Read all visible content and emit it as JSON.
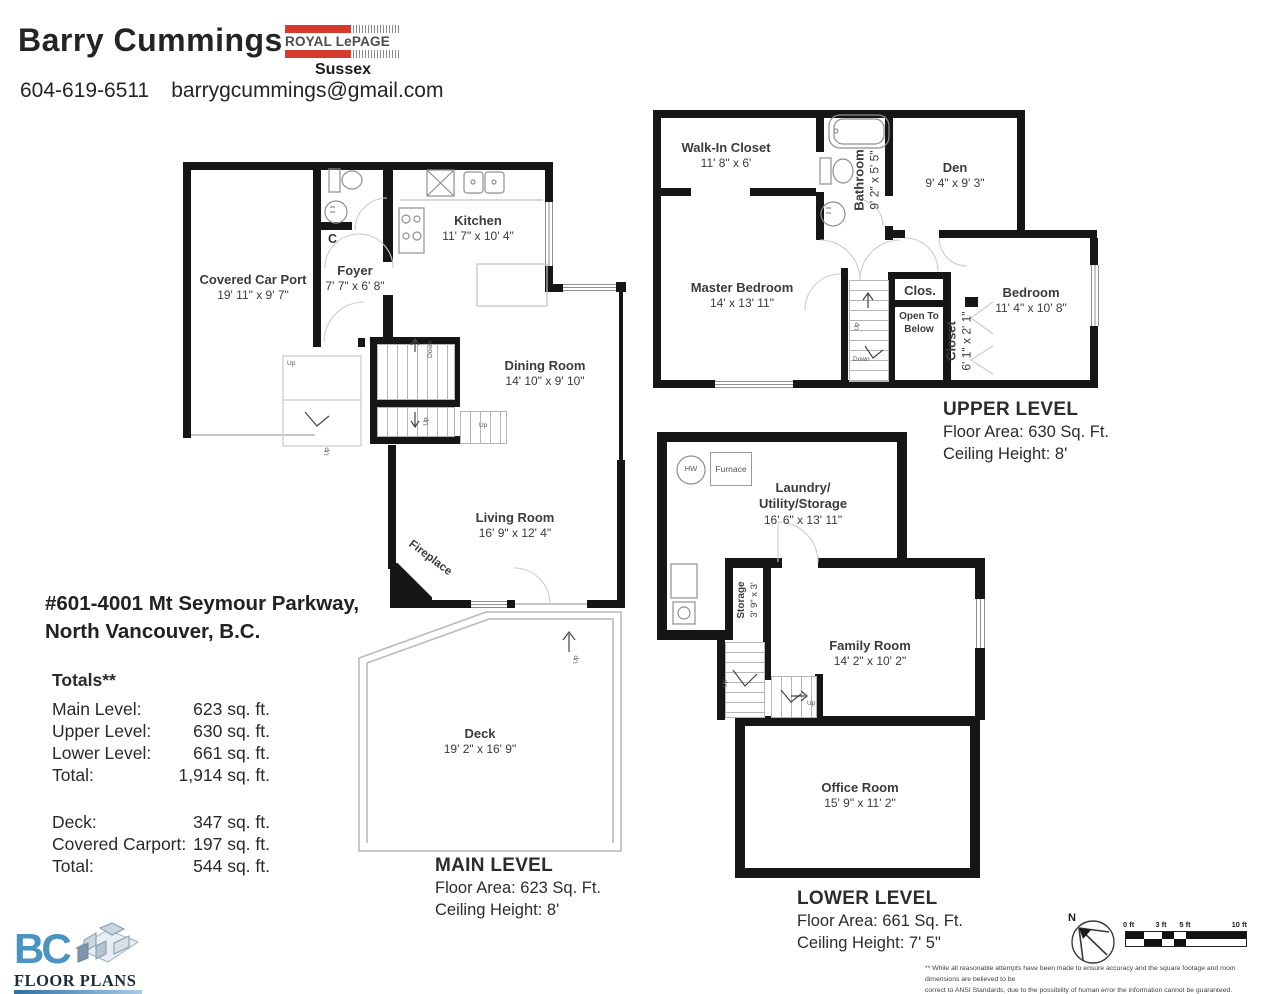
{
  "header": {
    "agent_name": "Barry Cummings",
    "phone": "604-619-6511",
    "email": "barrygcummings@gmail.com",
    "brokerage": {
      "brand": "ROYAL LePAGE",
      "office": "Sussex",
      "brand_color": "#d6392e"
    }
  },
  "address": {
    "line1": "#601-4001 Mt Seymour Parkway,",
    "line2": "North Vancouver, B.C."
  },
  "totals": {
    "title": "Totals**",
    "rows": [
      {
        "label": "Main Level:",
        "value": "623 sq. ft."
      },
      {
        "label": "Upper Level:",
        "value": "630 sq. ft."
      },
      {
        "label": "Lower Level:",
        "value": "661 sq. ft."
      },
      {
        "label": "Total:",
        "value": "1,914 sq. ft."
      }
    ],
    "rows2": [
      {
        "label": "Deck:",
        "value": "347 sq. ft."
      },
      {
        "label": "Covered Carport:",
        "value": "197 sq. ft."
      },
      {
        "label": "Total:",
        "value": "544 sq. ft."
      }
    ]
  },
  "levels": {
    "main": {
      "title": "MAIN LEVEL",
      "area": "Floor Area: 623 Sq. Ft.",
      "ceiling": "Ceiling Height: 8'"
    },
    "upper": {
      "title": "UPPER LEVEL",
      "area": "Floor Area: 630 Sq. Ft.",
      "ceiling": "Ceiling Height: 8'"
    },
    "lower": {
      "title": "LOWER LEVEL",
      "area": "Floor Area: 661 Sq. Ft.",
      "ceiling": "Ceiling Height: 7' 5\""
    }
  },
  "rooms": {
    "main": {
      "carport": {
        "name": "Covered Car Port",
        "dims": "19' 11\" x 9' 7\""
      },
      "foyer": {
        "name": "Foyer",
        "dims": "7' 7\" x 6' 8\""
      },
      "kitchen": {
        "name": "Kitchen",
        "dims": "11' 7\" x 10' 4\""
      },
      "dining": {
        "name": "Dining Room",
        "dims": "14' 10\" x 9' 10\""
      },
      "living": {
        "name": "Living Room",
        "dims": "16' 9\" x 12' 4\""
      },
      "deck": {
        "name": "Deck",
        "dims": "19' 2\" x 16' 9\""
      },
      "closet": {
        "name": "C"
      },
      "fireplace": {
        "name": "Fireplace"
      }
    },
    "upper": {
      "walkin": {
        "name": "Walk-In Closet",
        "dims": "11' 8\" x 6'"
      },
      "bathroom": {
        "name": "Bathroom",
        "dims": "9' 2\" x 5' 5\""
      },
      "den": {
        "name": "Den",
        "dims": "9' 4\" x 9' 3\""
      },
      "master": {
        "name": "Master Bedroom",
        "dims": "14' x 13' 11\""
      },
      "clos": {
        "name": "Clos."
      },
      "open_below": {
        "line1": "Open To",
        "line2": "Below"
      },
      "closet": {
        "name": "Closet",
        "dims": "6' 1\" x 2' 1\""
      },
      "bedroom": {
        "name": "Bedroom",
        "dims": "11' 4\" x 10' 8\""
      }
    },
    "lower": {
      "laundry": {
        "line1": "Laundry/",
        "line2": "Utility/Storage",
        "dims": "16' 6\" x 13' 11\""
      },
      "storage": {
        "name": "Storage",
        "dims": "3' 9\" x 3'"
      },
      "family": {
        "name": "Family Room",
        "dims": "14' 2\" x 10' 2\""
      },
      "office": {
        "name": "Office Room",
        "dims": "15' 9\" x 11' 2\""
      },
      "hw": {
        "name": "HW"
      },
      "furnace": {
        "name": "Furnace"
      }
    }
  },
  "stairs": {
    "up": "Up",
    "down": "Down"
  },
  "footer": {
    "logo": {
      "bc": "BC",
      "floor_plans": "FLOOR PLANS"
    },
    "compass_n": "N",
    "scale": {
      "labels": [
        "0 ft",
        "3 ft",
        "5 ft",
        "10 ft"
      ]
    },
    "disclaimer_line1": "** While all reasonable attempts have been made to ensure accuracy and the square footage and room dimensions are believed to be",
    "disclaimer_line2": "correct to ANSI Standards, due to the possibility of human error the information cannot be guaranteed. E&O Insured for $1,000,000"
  }
}
